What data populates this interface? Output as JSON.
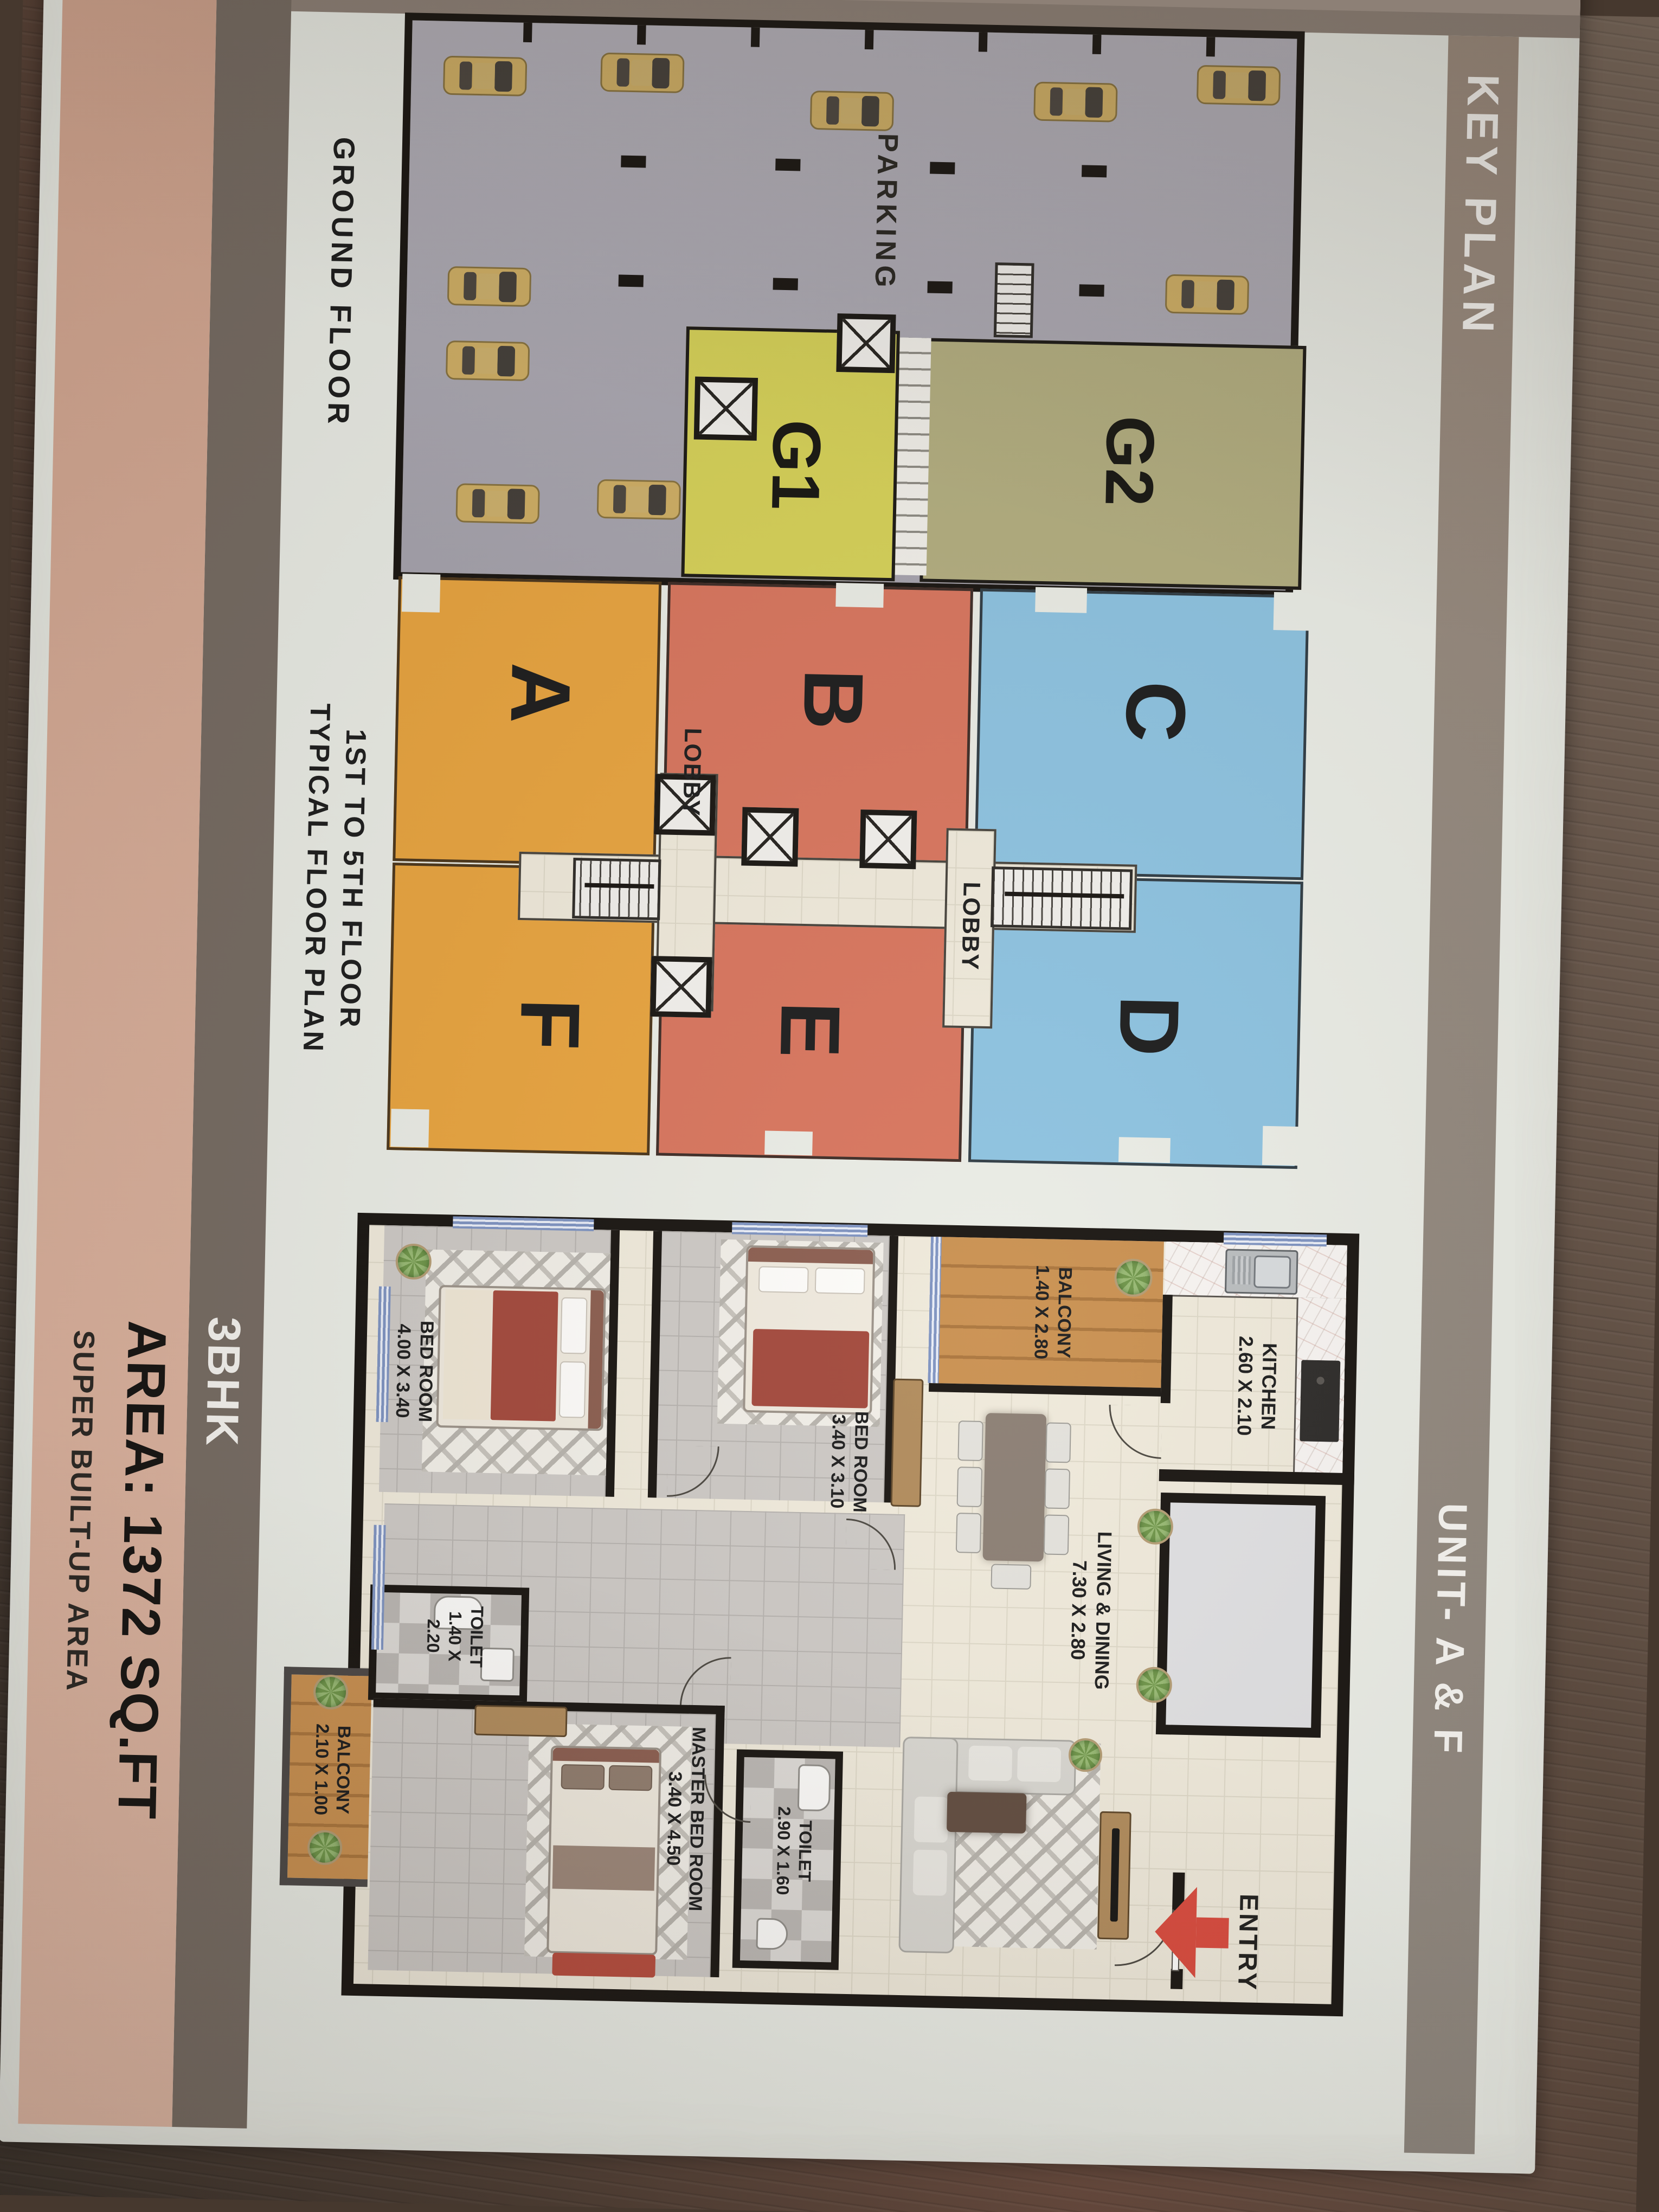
{
  "header": {
    "key_plan": "KEY PLAN",
    "unit_title": "UNIT- A & F"
  },
  "ground": {
    "caption": "GROUND FLOOR",
    "parking": "PARKING",
    "g1": "G1",
    "g2": "G2"
  },
  "typical": {
    "caption1": "1ST TO 5TH FLOOR",
    "caption2": "TYPICAL FLOOR PLAN",
    "unit_a": "A",
    "unit_b": "B",
    "unit_c": "C",
    "unit_d": "D",
    "unit_e": "E",
    "unit_f": "F",
    "lobby1": "LOBBY",
    "lobby2": "LOBBY"
  },
  "apartment": {
    "entry": "ENTRY",
    "bedroom1": {
      "name": "BED ROOM",
      "dims": "4.00 X 3.40"
    },
    "bedroom2": {
      "name": "BED ROOM",
      "dims": "3.40 X 3.10"
    },
    "balcony1": {
      "name": "BALCONY",
      "dims": "1.40 X 2.80"
    },
    "kitchen": {
      "name": "KITCHEN",
      "dims": "2.60 X 2.10"
    },
    "living": {
      "name": "LIVING & DINING",
      "dims": "7.30 X 2.80"
    },
    "toilet1": {
      "name": "TOILET",
      "dims_a": "1.40 X",
      "dims_b": "2.20"
    },
    "master": {
      "name": "MASTER BED ROOM",
      "dims": "3.40 X 4.50"
    },
    "balcony2": {
      "name": "BALCONY",
      "dims": "2.10 X 1.00"
    },
    "toilet2": {
      "name": "TOILET",
      "dims": "2.90 X 1.60"
    }
  },
  "summary": {
    "bhk": "3BHK",
    "area": "AREA: 1372 SQ.FT",
    "note": "SUPER BUILT-UP AREA"
  },
  "colors": {
    "unit_af_orange": "#e8a33d",
    "unit_be_salmon": "#d8745c",
    "unit_cd_blue": "#8cc2e0",
    "g1_yellow": "#d6d156",
    "g2_olive": "#b2ad7e",
    "parking_gray": "#a9a6b0",
    "band_taupe": "#98897c",
    "tan_band": "#d9ae99",
    "entry_arrow_red": "#d9483b"
  }
}
